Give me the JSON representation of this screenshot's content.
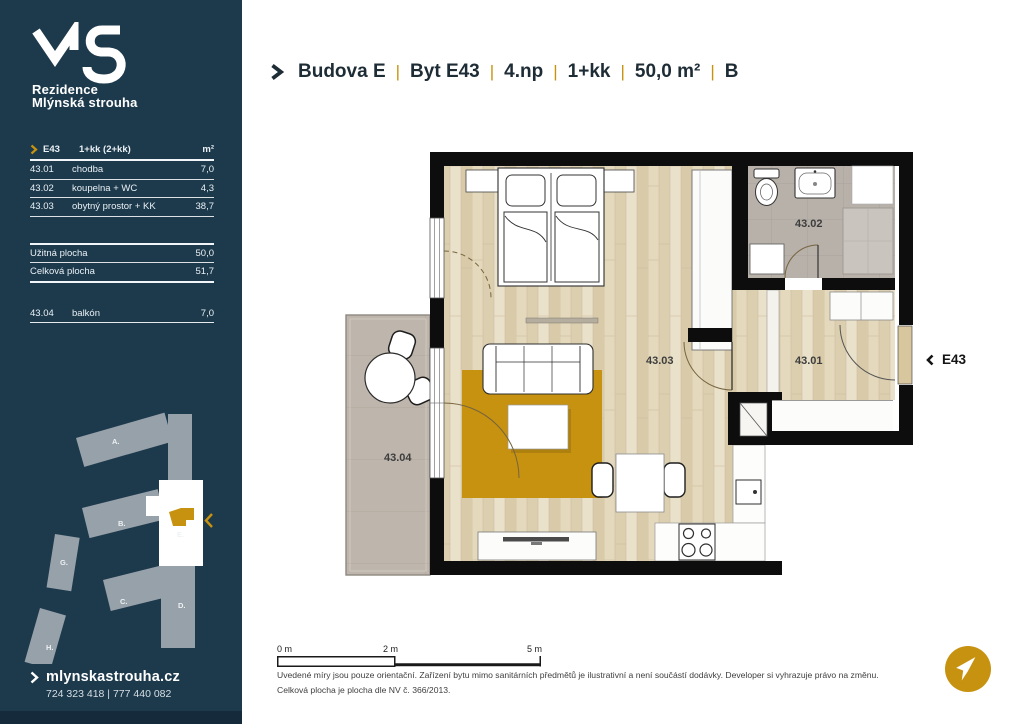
{
  "colors": {
    "sidebar_bg": "#1d3a4d",
    "accent_gold": "#c7920f",
    "wall_black": "#0d0d0d",
    "wood_floor": "#e4d9bd",
    "tile_gray": "#b7b1aa"
  },
  "sidebar": {
    "logo": {
      "line1": "Rezidence",
      "line2": "Mlýnská strouha"
    },
    "table": {
      "header": {
        "unit": "E43",
        "layout": "1+kk (2+kk)",
        "area_unit": "m²"
      },
      "rooms": [
        {
          "code": "43.01",
          "name": "chodba",
          "area": "7,0"
        },
        {
          "code": "43.02",
          "name": "koupelna + WC",
          "area": "4,3"
        },
        {
          "code": "43.03",
          "name": "obytný prostor + KK",
          "area": "38,7"
        }
      ],
      "summary": [
        {
          "name": "Užitná plocha",
          "area": "50,0"
        },
        {
          "name": "Celková plocha",
          "area": "51,7"
        }
      ],
      "extras": [
        {
          "code": "43.04",
          "name": "balkón",
          "area": "7,0"
        }
      ]
    },
    "siteplan": {
      "a": "A.",
      "b": "B.",
      "c": "C.",
      "d": "D.",
      "e": "E.",
      "g": "G.",
      "h": "H."
    },
    "contact": {
      "website": "mlynskastrouha.cz",
      "phones": "724 323 418 | 777 440 082"
    }
  },
  "header": {
    "separator": "|",
    "items": [
      "Budova E",
      "Byt E43",
      "4.np",
      "1+kk",
      "50,0 m²",
      "B"
    ]
  },
  "plan": {
    "labels": {
      "living": "43.03",
      "hall": "43.01",
      "bath": "43.02",
      "balcony": "43.04"
    },
    "entrance": "E43"
  },
  "scalebar": {
    "t0": "0 m",
    "t2": "2 m",
    "t5": "5 m"
  },
  "disclaimer": {
    "line1": "Uvedené míry jsou pouze orientační. Zařízení bytu mimo sanitárních předmětů je ilustrativní a není součástí dodávky. Developer si vyhrazuje právo na změnu.",
    "line2": "Celková plocha je plocha dle NV č. 366/2013."
  }
}
